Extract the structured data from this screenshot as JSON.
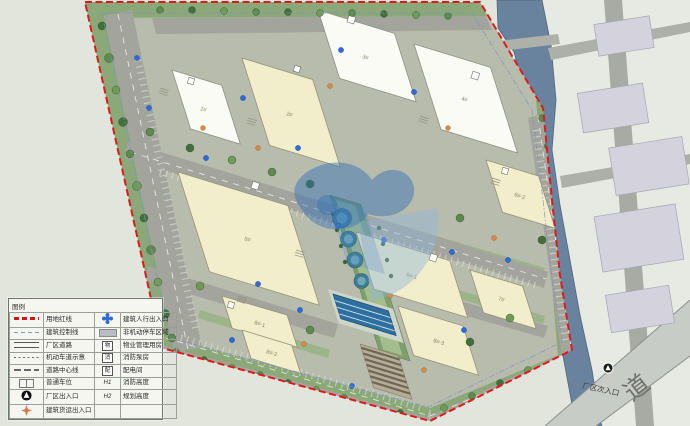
{
  "page": {
    "type": "site-master-plan"
  },
  "legend": {
    "title": "图例",
    "left": [
      {
        "label": "用地红线"
      },
      {
        "label": "建筑控制线"
      },
      {
        "label": "厂区道路"
      },
      {
        "label": "机动车道示意"
      },
      {
        "label": "道路中心线"
      },
      {
        "label": "普通车位"
      },
      {
        "label": "厂区出入口"
      },
      {
        "label": "建筑货运出入口"
      }
    ],
    "right": [
      {
        "label": "建筑人行出入口"
      },
      {
        "label": "非机动停车区域"
      },
      {
        "symbol": "物",
        "label": "物业管理用房"
      },
      {
        "symbol": "消",
        "label": "消防泵房"
      },
      {
        "symbol": "配",
        "label": "配电间"
      },
      {
        "symbol": "H1",
        "label": "消防高度"
      },
      {
        "symbol": "H2",
        "label": "规划高度"
      }
    ]
  },
  "map": {
    "secondary_entrance_label": "厂区次入口",
    "road_label": "道",
    "building_labels": [
      "1#",
      "2#",
      "3#",
      "4#",
      "5#",
      "6#-1",
      "6#-2",
      "7#",
      "8#-1",
      "8#-2",
      "8#-3"
    ]
  },
  "colors": {
    "boundary_red": "#e01a1a",
    "control_line_blue": "#7d8fc9",
    "river": "#69839f",
    "road": "#a3a49b",
    "cream_building": "#f2edca",
    "white_building": "#fbfbf5",
    "green": "#7e9e6b",
    "watermark_blue": "#2f6fb5",
    "pedestrian_dot": "#2e6bd8",
    "freight_dot": "#d98a43"
  }
}
